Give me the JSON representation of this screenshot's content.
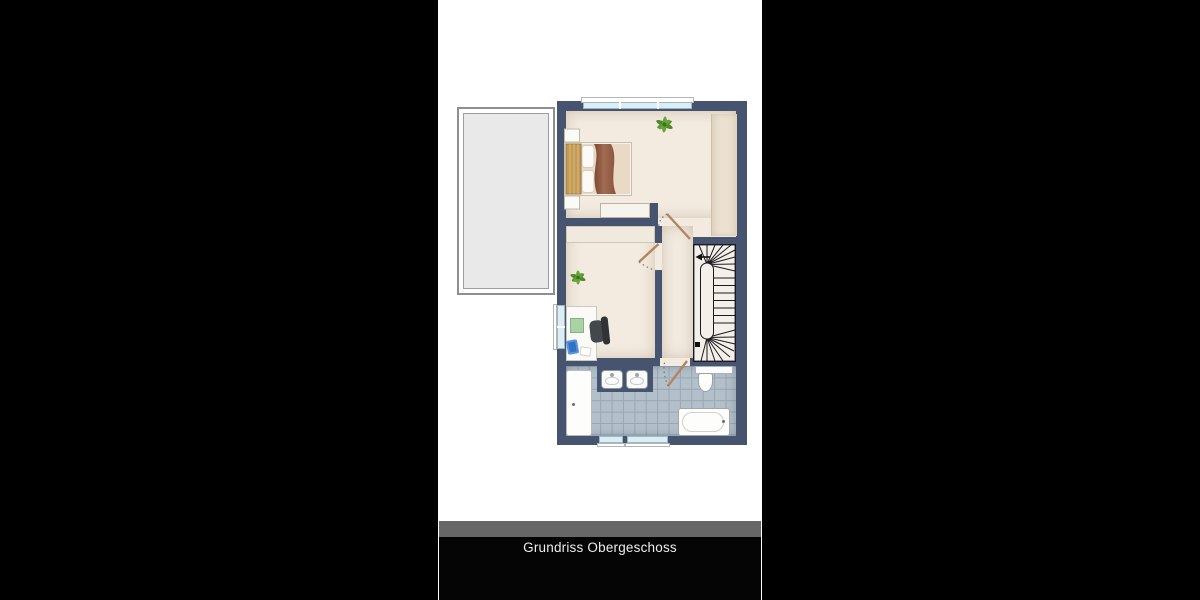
{
  "caption": {
    "title": "Grundriss Obergeschoss"
  },
  "colors": {
    "background": "#000000",
    "photo_bg": "#ffffff",
    "wall": "#475470",
    "floor": "#f3ebe0",
    "tile": "#b3c0ca",
    "tile_line": "#97a7b4",
    "balcony_fill": "#e9e9e9",
    "balcony_border": "#8f8f8f",
    "glass": "#d9eef5",
    "stair_bg": "#f4f0e9",
    "stair_line": "#1a1a20",
    "wood": "#c49a55",
    "duvet": "#e9dac5",
    "wardrobe": "#ece1d0",
    "cabinet": "#f0eade",
    "plant": "#55922e",
    "desk_pad": "#a9d3a4",
    "laptop": "#2f72c8",
    "chair": "#3c4146",
    "door_leaf": "#b5835f",
    "caption_bar": "#676767",
    "caption_bg": "#050505",
    "caption_text": "#ededed"
  },
  "plan": {
    "areas": [
      "balcony",
      "bedroom",
      "office",
      "hallway",
      "stairs",
      "bathroom"
    ],
    "fixtures": [
      "double-bed",
      "nightstands",
      "wardrobe",
      "plant",
      "desk",
      "office-chair",
      "laptop",
      "shower",
      "double-sink-vanity",
      "toilet",
      "bathtub",
      "winder-staircase",
      "windows",
      "swing-doors"
    ]
  }
}
